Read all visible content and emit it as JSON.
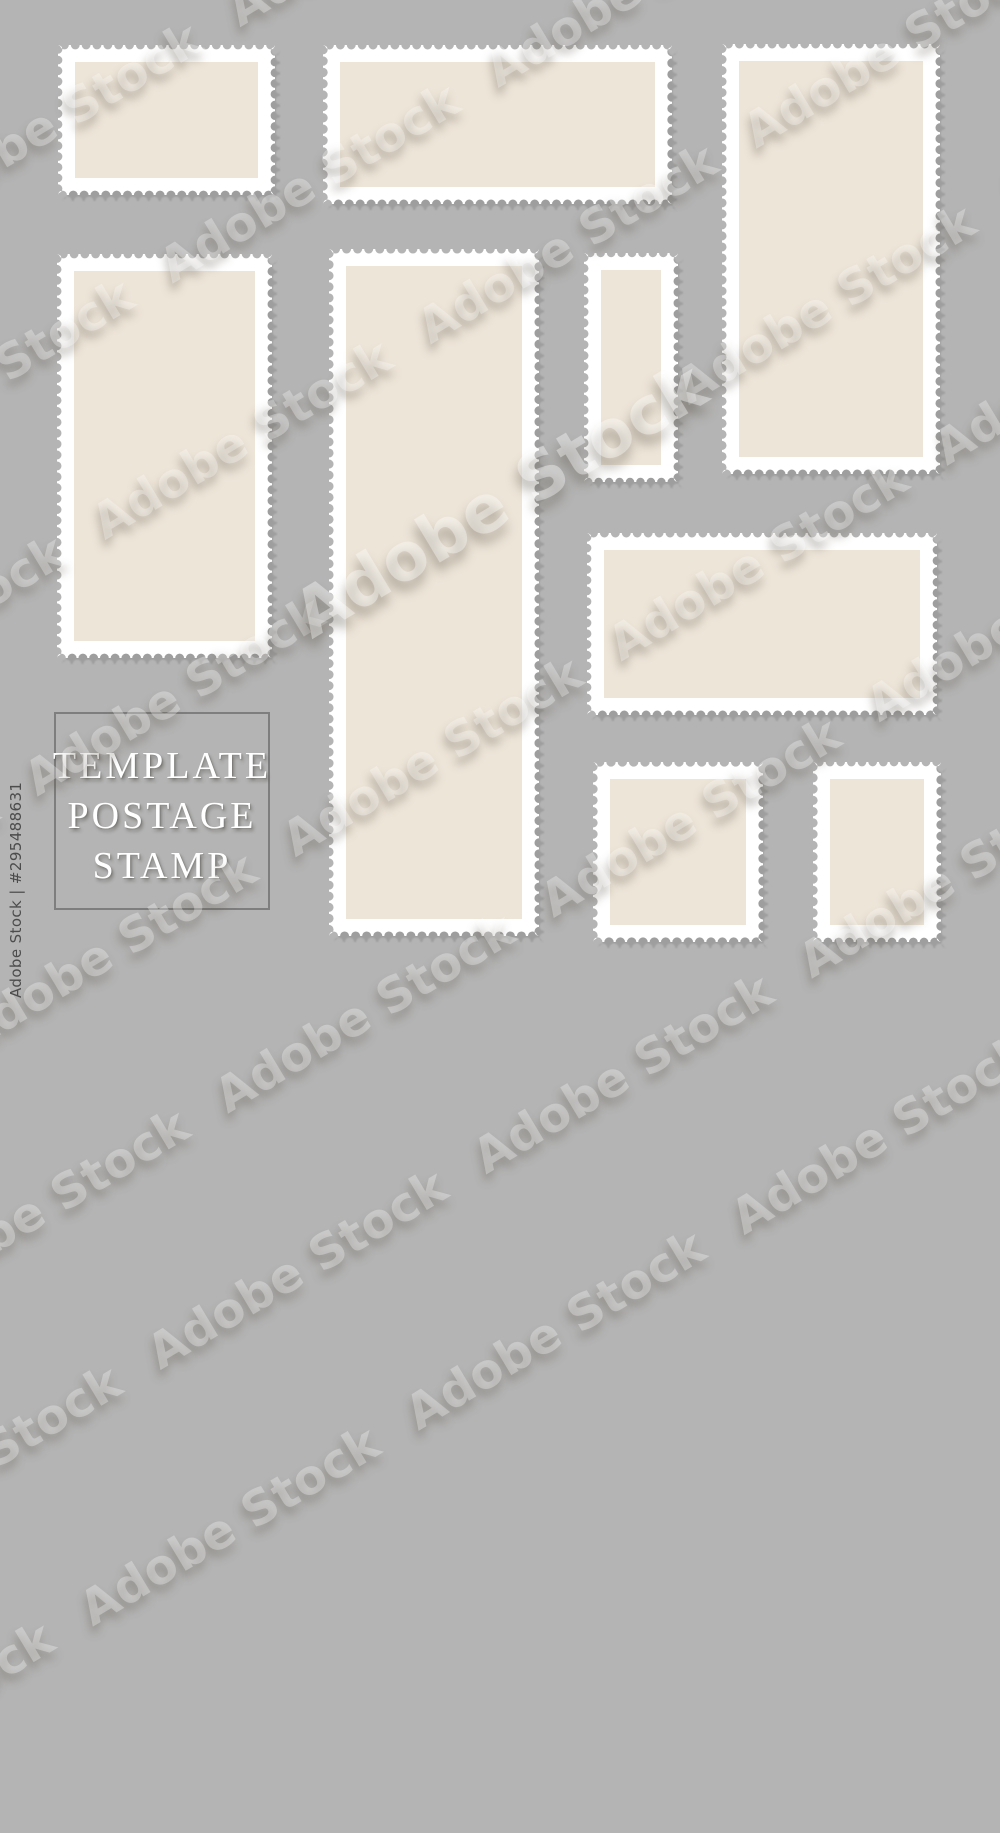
{
  "title": "Template postage stamp",
  "colors": {
    "background": "#b4b4b4",
    "stamp_border": "#ffffff",
    "stamp_fill": "#ede5d8",
    "stamp_shadow": "#9e9e9e",
    "frame_border": "#7e7e7e",
    "frame_text": "#ffffff",
    "watermark_text": "#ffffff",
    "attribution_text": "#4c4c4c"
  },
  "frame": {
    "lines": [
      "TEMPLATE",
      "POSTAGE",
      "STAMP"
    ]
  },
  "watermark": {
    "text": "Adobe Stock"
  },
  "attribution": {
    "text": "Adobe Stock | #295488631"
  },
  "stamps": [
    {
      "name": "stamp-top-left",
      "x": 58,
      "y": 45,
      "w": 217,
      "h": 150
    },
    {
      "name": "stamp-top-center-wide",
      "x": 323,
      "y": 45,
      "w": 349,
      "h": 159
    },
    {
      "name": "stamp-top-right-tall",
      "x": 722,
      "y": 44,
      "w": 218,
      "h": 430
    },
    {
      "name": "stamp-left-tall",
      "x": 57,
      "y": 254,
      "w": 215,
      "h": 404
    },
    {
      "name": "stamp-center-tall",
      "x": 329,
      "y": 249,
      "w": 210,
      "h": 687
    },
    {
      "name": "stamp-middle-small",
      "x": 584,
      "y": 253,
      "w": 94,
      "h": 229
    },
    {
      "name": "stamp-right-wide",
      "x": 587,
      "y": 533,
      "w": 350,
      "h": 182
    },
    {
      "name": "stamp-bottom-square",
      "x": 593,
      "y": 762,
      "w": 170,
      "h": 180
    },
    {
      "name": "stamp-bottom-right-small",
      "x": 813,
      "y": 762,
      "w": 128,
      "h": 180
    }
  ]
}
